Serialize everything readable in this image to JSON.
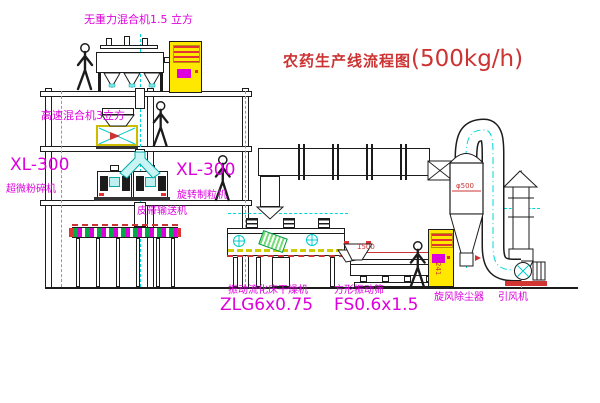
{
  "title": {
    "text_cn": "农药生产线流程图",
    "text_rate": "(500kg/h)"
  },
  "labels": {
    "zero_gravity_mixer": "无重力混合机1.5 立方",
    "high_speed_mixer": "高速混合机3立方",
    "pulverizer_model": "XL-300",
    "pulverizer_name": "超微粉碎机",
    "granulator_model": "XL-300",
    "granulator_name": "旋转制粒机",
    "belt_conveyor": "皮带输送机",
    "fluid_bed_dryer_name": "振动流化床干燥机",
    "fluid_bed_dryer_model": "ZLG6x0.75",
    "square_sieve_name": "方形振动筛",
    "square_sieve_model": "FS0.6x1.5",
    "cyclone_collector": "旋风除尘器",
    "induced_draft_fan": "引风机"
  },
  "dimensions": {
    "sieve_length": "1500",
    "sieve_height": "241",
    "cyclone_diameter": "φ500"
  },
  "colors": {
    "label_magenta": "#dd00dd",
    "title_red": "#cc3333",
    "centerline_cyan": "#00d8d8",
    "cabinet_yellow": "#ffe800",
    "line_black": "#1c1c1c"
  }
}
